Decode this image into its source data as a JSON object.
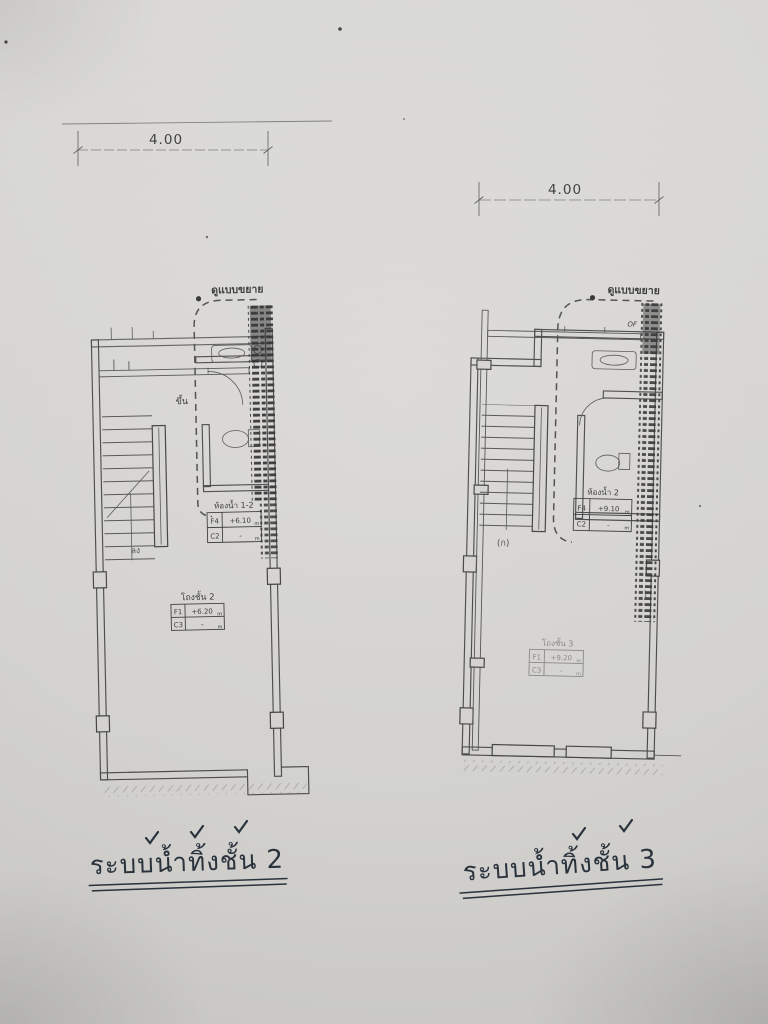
{
  "plans": [
    {
      "dimension": "4.00",
      "detail_callout": "ดูแบบขยาย",
      "stair_up_label": "ขึ้น",
      "stair_down_label": "ลง",
      "room_tables": [
        {
          "title": "ห้องน้ำ 1-2",
          "rows": [
            [
              "F4",
              "+6.10",
              "m"
            ],
            [
              "C2",
              "-",
              "m"
            ]
          ]
        },
        {
          "title": "โถงชั้น 2",
          "rows": [
            [
              "F1",
              "+6.20",
              "m"
            ],
            [
              "C3",
              "-",
              "m"
            ]
          ]
        }
      ],
      "caption": "ระบบน้ำทิ้งชั้น 2"
    },
    {
      "dimension": "4.00",
      "detail_callout": "ดูแบบขยาย",
      "stair_down_label": "(ก)",
      "pipe_label": "OF",
      "room_tables": [
        {
          "title": "ห้องน้ำ 2",
          "rows": [
            [
              "F4",
              "+9.10",
              "m"
            ],
            [
              "C2",
              "-",
              "m"
            ]
          ]
        },
        {
          "title": "โถงชั้น 3",
          "rows": [
            [
              "F1",
              "+9.20",
              "m"
            ],
            [
              "C3",
              "-",
              "m"
            ]
          ]
        }
      ],
      "caption": "ระบบน้ำทิ้งชั้น 3"
    }
  ]
}
